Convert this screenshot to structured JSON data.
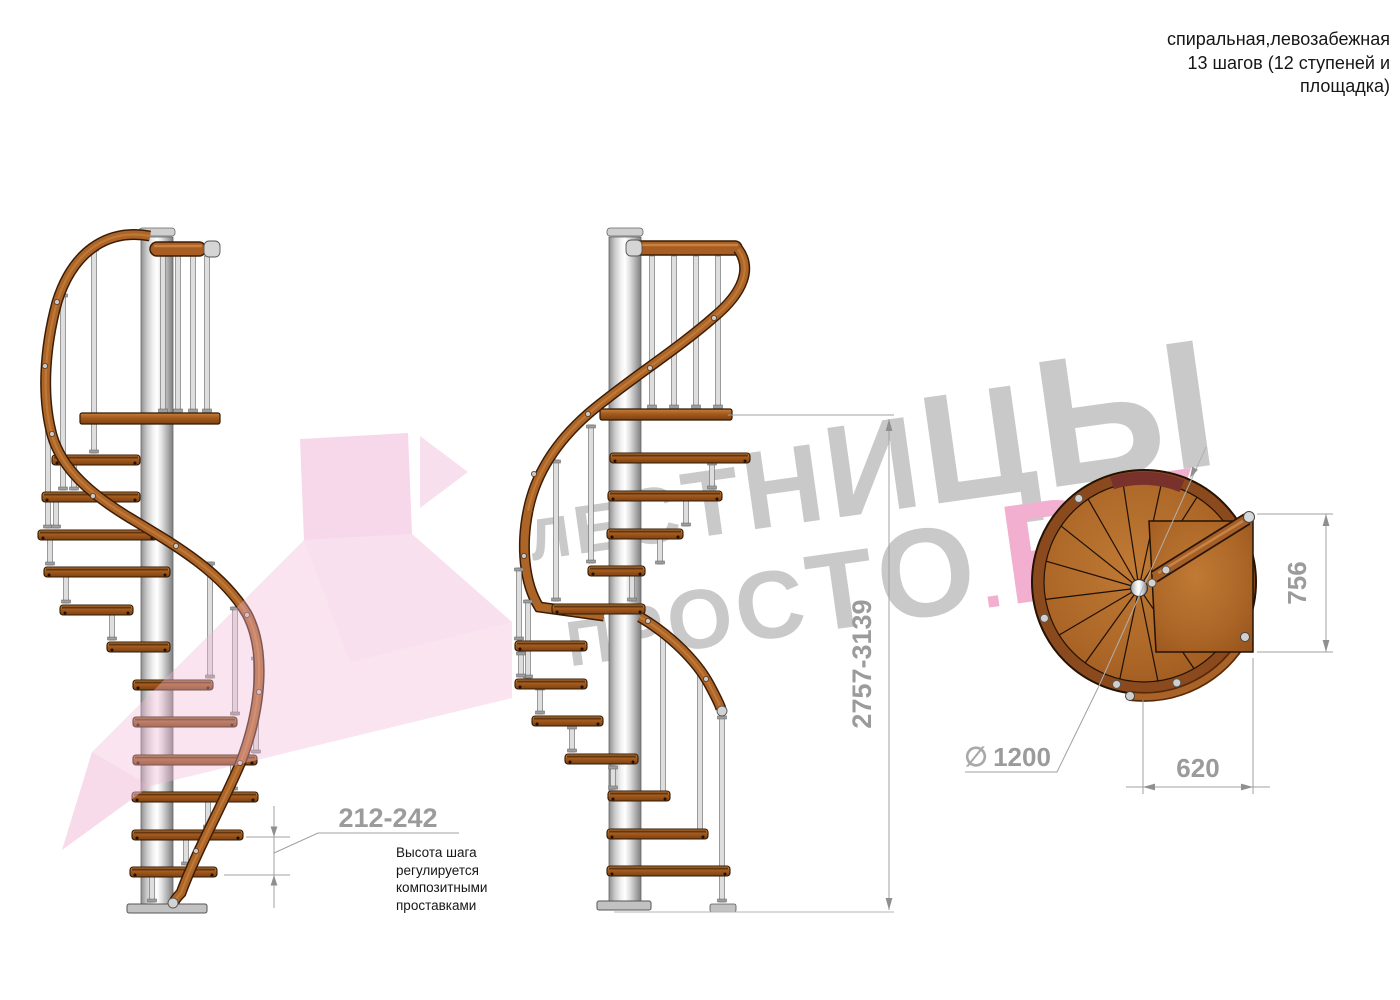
{
  "title": {
    "line1": "спиральная,левозабежная",
    "line2": "13 шагов (12 ступеней и",
    "line3": "площадка)"
  },
  "watermark": {
    "line1": "ЛЕСТНИЦЫ",
    "line2_gray": "ПРОСТО",
    "line2_accent": ".РУ",
    "text_color": "#c9c9c9",
    "accent_color": "#f2afd0"
  },
  "dimensions": {
    "step_height": {
      "value": "212-242",
      "note_lines": [
        "Высота шага",
        "регулируется",
        "композитными",
        "проставками"
      ]
    },
    "total_height": "2757-3139",
    "platform_depth": "756",
    "platform_width": "620",
    "diameter_symbol": "∅",
    "diameter": "1200"
  },
  "colors": {
    "wood": "#ad6527",
    "rail_dark": "#3c1c04",
    "metal": "#d9d9d9",
    "dimension_gray": "#9b9b9b",
    "ink": "#161616",
    "watermark_pink_arrow": "#f0b7d8"
  }
}
